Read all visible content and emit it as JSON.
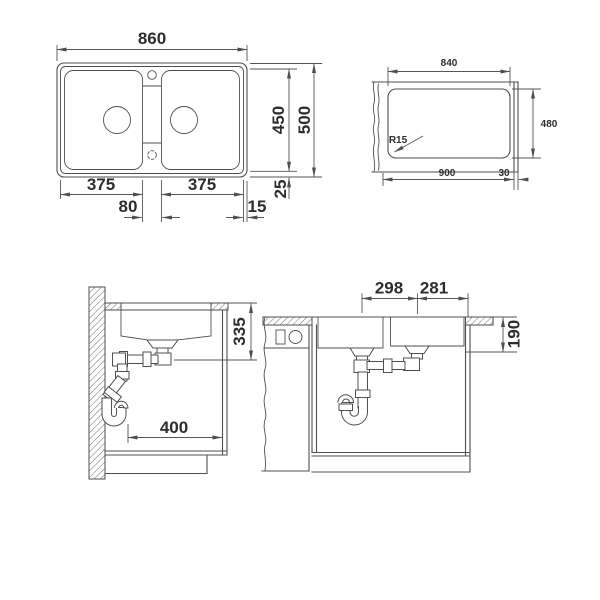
{
  "drawing": {
    "plan": {
      "width": "860",
      "depth_inner": "450",
      "depth": "500",
      "bowl_left": "375",
      "bowl_right": "375",
      "web": "80",
      "margin": "15",
      "rim": "25"
    },
    "cutout": {
      "width": "840",
      "depth": "480",
      "base_width": "900",
      "edge": "30",
      "radius": "R15"
    },
    "side": {
      "drain_height": "335",
      "drain_offset": "400"
    },
    "front": {
      "drain_spacing": "298",
      "drain_right": "281",
      "bowl_depth": "190"
    }
  },
  "colors": {
    "line": "#4f4f4f",
    "text": "#2d2d2d",
    "background": "#ffffff"
  }
}
